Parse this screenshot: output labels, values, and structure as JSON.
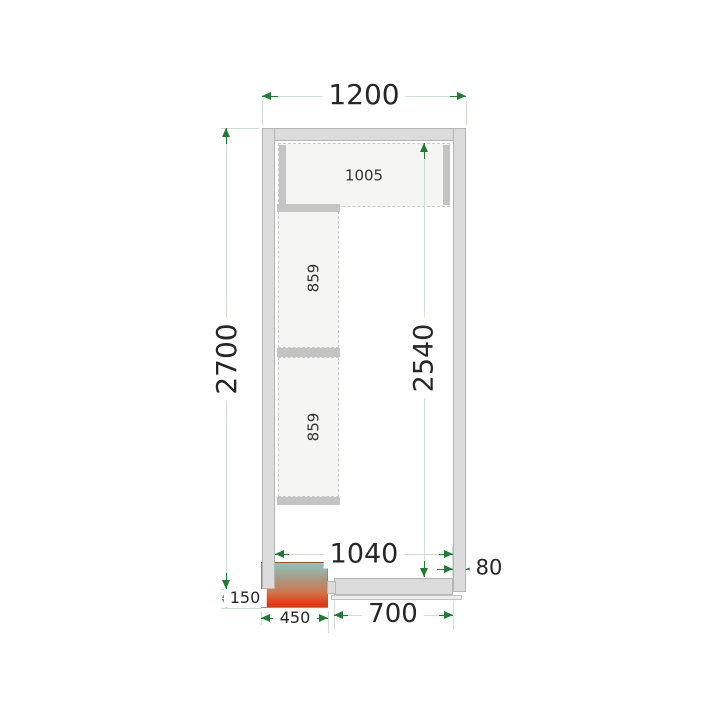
{
  "drawing_type": "cold-room-floor-plan",
  "dimensions": {
    "overall_width": "1200",
    "overall_depth": "2700",
    "interior_depth": "2540",
    "interior_width": "1040",
    "wall_thickness": "80",
    "unit_protrusion": "150",
    "unit_width": "450",
    "door_panel_width": "700"
  },
  "shelves": {
    "top_shelf": "1005",
    "left_shelf_upper": "859",
    "left_shelf_lower": "859"
  },
  "colors": {
    "arrow_green": "#1f7d33",
    "dim_line": "#cfdfcf",
    "wall_fill": "#dcdcdc",
    "shelf_fill": "#f5f5f3",
    "bar_fill": "#c4c4c4",
    "unit_gradient_top": "#8ec4be",
    "unit_gradient_bottom": "#df330f",
    "text": "#262626"
  }
}
